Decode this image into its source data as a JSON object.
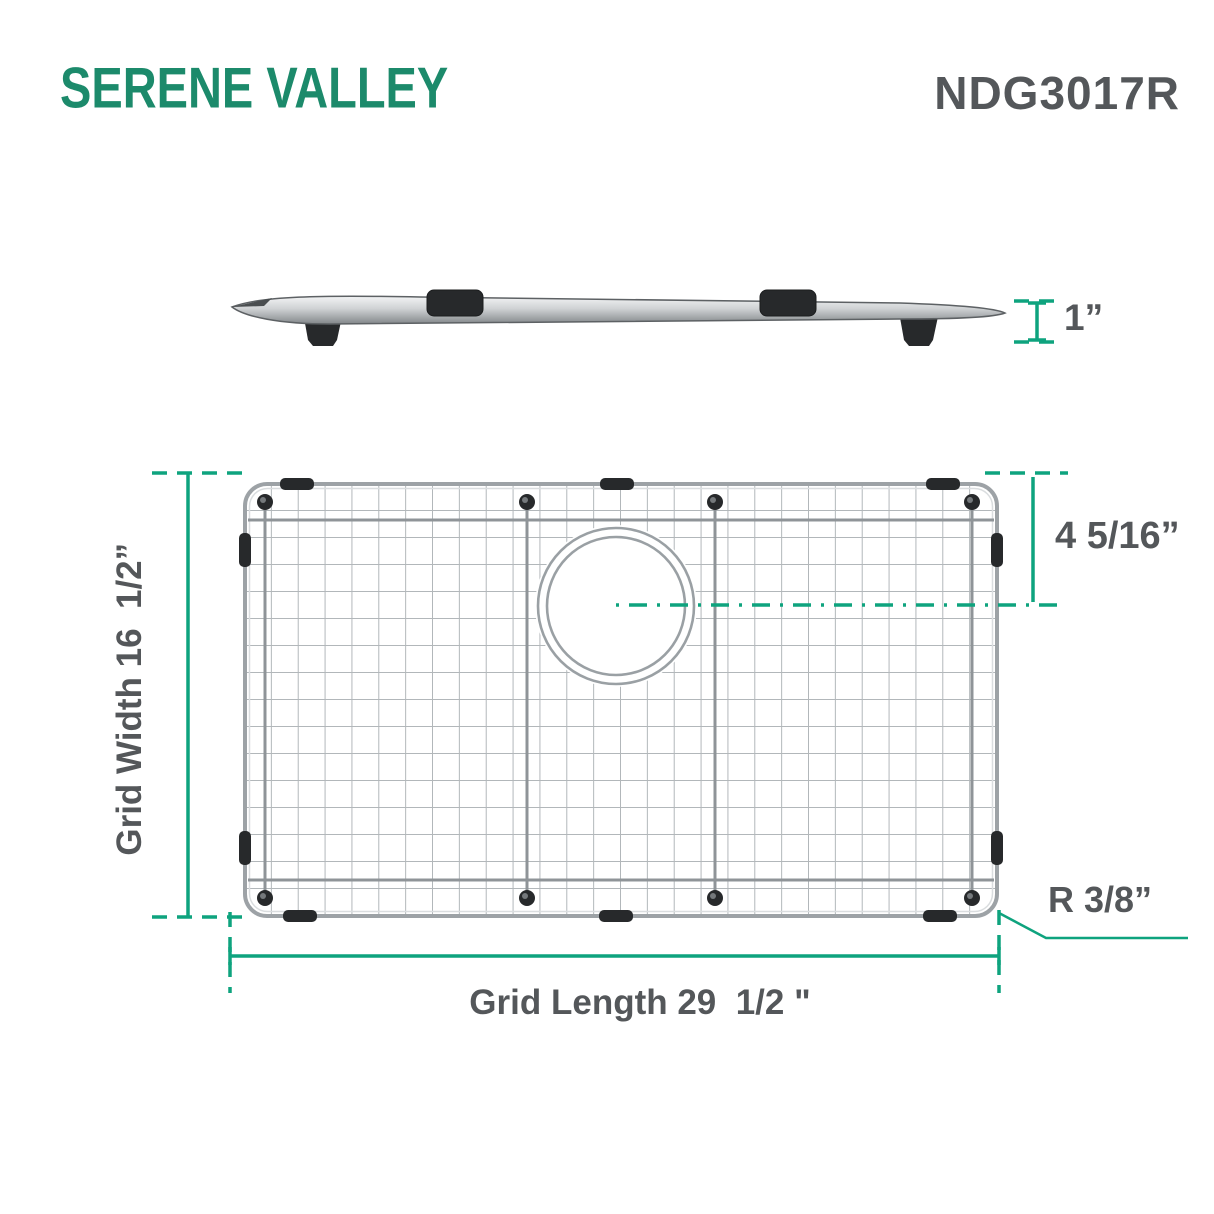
{
  "header": {
    "brand": "SERENE VALLEY",
    "model": "NDG3017R"
  },
  "side_view": {
    "height_dim": "1”"
  },
  "top_view": {
    "width_dim": "Grid Width 16  1/2”",
    "drain_center_dim": "4 5/16”",
    "corner_radius_dim": "R 3/8”",
    "length_dim": "Grid Length 29  1/2 \""
  },
  "colors": {
    "brand_green": "#1c8a6b",
    "dimension_teal": "#0ea37e",
    "label_gray": "#54575a",
    "wire_gray": "#b2b7ba",
    "rubber_black": "#27292b"
  }
}
